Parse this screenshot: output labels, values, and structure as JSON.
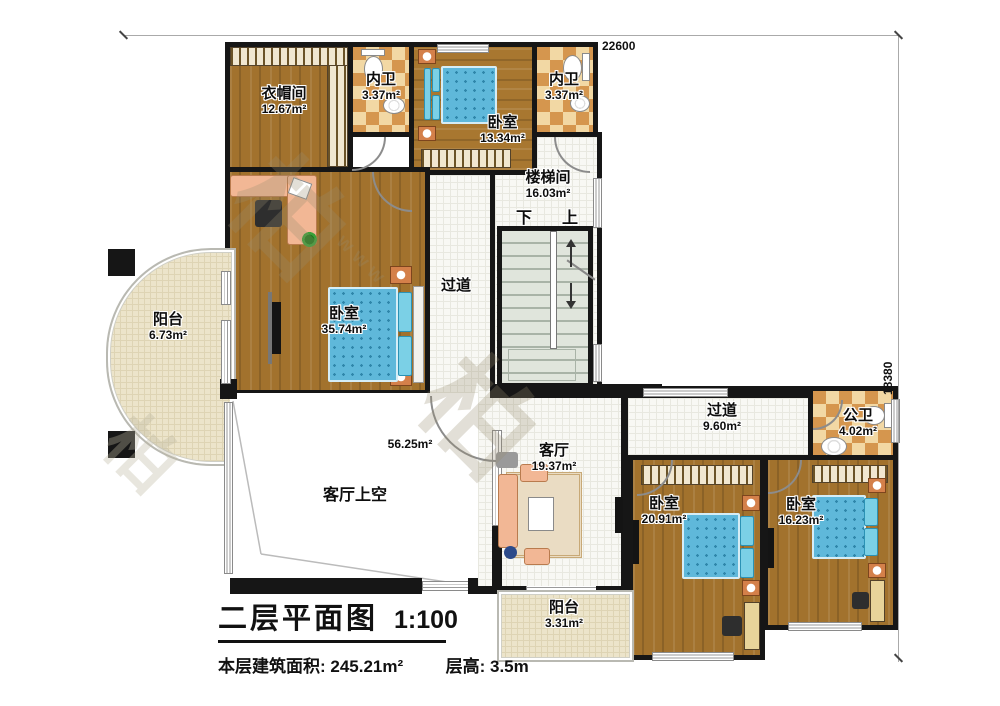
{
  "dimensions": {
    "top": "22600",
    "right": "18380"
  },
  "stairs": {
    "down": "下",
    "up": "上"
  },
  "rooms": {
    "cloakroom": {
      "name": "衣帽间",
      "area": "12.67m²"
    },
    "bath1": {
      "name": "内卫",
      "area": "3.37m²"
    },
    "bedroom_top": {
      "name": "卧室",
      "area": "13.34m²"
    },
    "bath2": {
      "name": "内卫",
      "area": "3.37m²"
    },
    "stairwell": {
      "name": "楼梯间",
      "area": "16.03m²"
    },
    "corridor_center": {
      "name": "过道"
    },
    "balcony_left": {
      "name": "阳台",
      "area": "6.73m²"
    },
    "bedroom_master": {
      "name": "卧室",
      "area": "35.74m²"
    },
    "void": {
      "name": "客厅上空",
      "area_label": "56.25m²"
    },
    "living": {
      "name": "客厅",
      "area": "19.37m²"
    },
    "corridor_right": {
      "name": "过道",
      "area": "9.60m²"
    },
    "bath_public": {
      "name": "公卫",
      "area": "4.02m²"
    },
    "bedroom_b1": {
      "name": "卧室",
      "area": "20.91m²"
    },
    "bedroom_b2": {
      "name": "卧室",
      "area": "16.23m²"
    },
    "balcony_bottom": {
      "name": "阳台",
      "area": "3.31m²"
    }
  },
  "title_block": {
    "title": "二层平面图",
    "scale": "1:100",
    "floor_area": "本层建筑面积: 245.21m²",
    "floor_height": "层高: 3.5m"
  },
  "watermark": {
    "glyph1": "柏",
    "glyph2": "柏",
    "url": "www"
  }
}
